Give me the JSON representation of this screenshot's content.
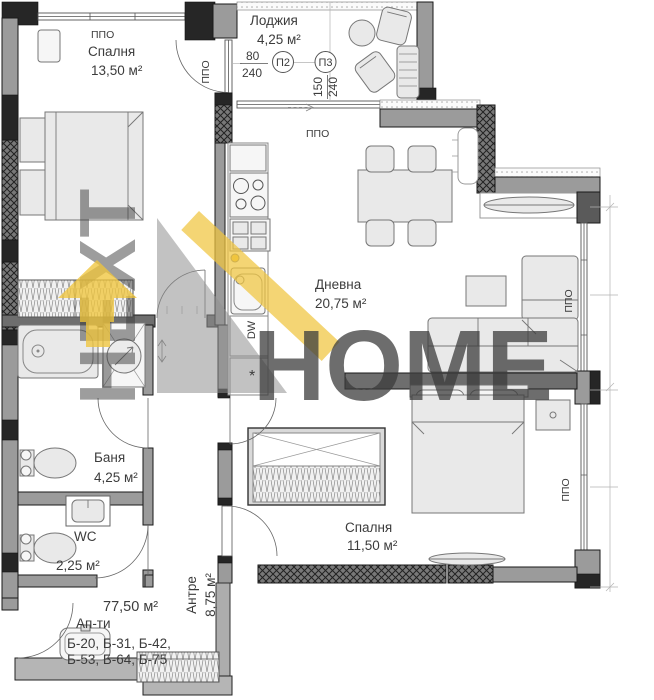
{
  "rooms": {
    "bedroom1": {
      "name": "Спалня",
      "area": "13,50 м²"
    },
    "loggia": {
      "name": "Лоджия",
      "area": "4,25 м²"
    },
    "living": {
      "name": "Дневна",
      "area": "20,75 м²"
    },
    "bath": {
      "name": "Баня",
      "area": "4,25 м²"
    },
    "wc": {
      "name": "WC",
      "area": "2,25 м²"
    },
    "bedroom2": {
      "name": "Спалня",
      "area": "11,50 м²"
    },
    "hall": {
      "name": "Антре",
      "area": "8,75 м²"
    }
  },
  "summary": {
    "total_area": "77,50 м²",
    "type_label": "Ап-ти",
    "units_line1": "Б-20, Б-31, Б-42,",
    "units_line2": "Б-53, Б-64, Б-75"
  },
  "windows": {
    "ppo": "ППО",
    "p2": {
      "id": "П2",
      "width": "80",
      "height": "240"
    },
    "p3": {
      "id": "П3",
      "width": "150",
      "height": "240"
    }
  },
  "kitchen": {
    "dishwasher": "DW",
    "star": "*"
  },
  "watermark": {
    "brand_vertical": "НЕХТ",
    "brand_main": "HOME",
    "yellow": "#f0c53e",
    "gray": "#8f8f8f"
  }
}
